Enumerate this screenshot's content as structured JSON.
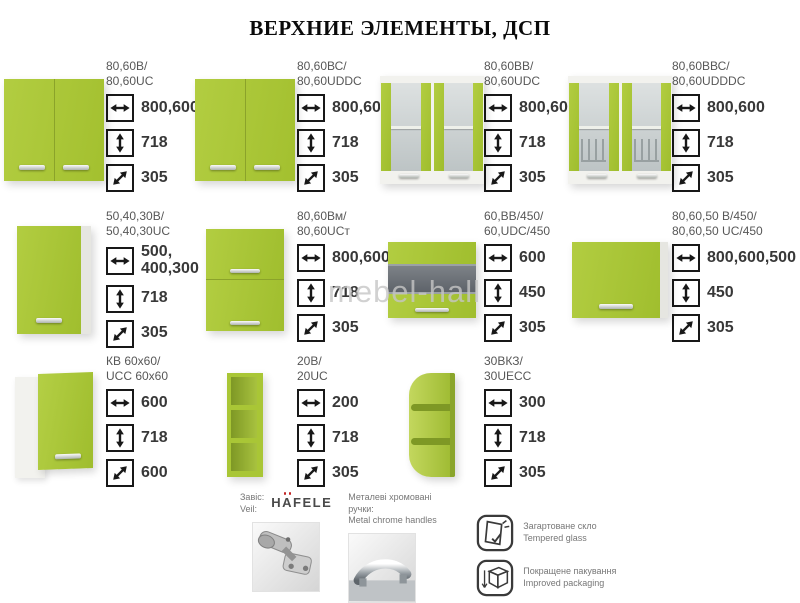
{
  "title": "ВЕРХНИЕ ЭЛЕМЕНТЫ, ДСП",
  "watermark": "mebel-hall",
  "colors": {
    "cabinet_green": "#a9c636",
    "green_dark": "#8ba32a",
    "carcass_white": "#f2f2ee",
    "glass_gray": "#c5cccd",
    "value_text": "#383838",
    "brand_accent_red": "#c22525"
  },
  "products": [
    {
      "label_line1": "80,60В/",
      "label_line2": "80,60UC",
      "type": "two-door",
      "specs": [
        {
          "icon": "width-icon",
          "value": "800,600"
        },
        {
          "icon": "height-icon",
          "value": "718"
        },
        {
          "icon": "depth-icon",
          "value": "305"
        }
      ]
    },
    {
      "label_line1": "80,60ВС/",
      "label_line2": "80,60UDDC",
      "type": "two-door",
      "specs": [
        {
          "icon": "width-icon",
          "value": "800,600"
        },
        {
          "icon": "height-icon",
          "value": "718"
        },
        {
          "icon": "depth-icon",
          "value": "305"
        }
      ]
    },
    {
      "label_line1": "80,60ВВ/",
      "label_line2": "80,60UDC",
      "type": "glass-two-door",
      "specs": [
        {
          "icon": "width-icon",
          "value": "800,600"
        },
        {
          "icon": "height-icon",
          "value": "718"
        },
        {
          "icon": "depth-icon",
          "value": "305"
        }
      ]
    },
    {
      "label_line1": "80,60ВВС/",
      "label_line2": "80,60UDDDC",
      "type": "glass-two-door-rack",
      "specs": [
        {
          "icon": "width-icon",
          "value": "800,600"
        },
        {
          "icon": "height-icon",
          "value": "718"
        },
        {
          "icon": "depth-icon",
          "value": "305"
        }
      ]
    },
    {
      "label_line1": "50,40,30В/",
      "label_line2": "50,40,30UC",
      "type": "single-door",
      "specs": [
        {
          "icon": "width-icon",
          "value": "500, 400,300"
        },
        {
          "icon": "height-icon",
          "value": "718"
        },
        {
          "icon": "depth-icon",
          "value": "305"
        }
      ]
    },
    {
      "label_line1": "80,60Вм/",
      "label_line2": "80,60UCт",
      "type": "flip-two",
      "specs": [
        {
          "icon": "width-icon",
          "value": "800,600"
        },
        {
          "icon": "height-icon",
          "value": "718"
        },
        {
          "icon": "depth-icon",
          "value": "305"
        }
      ]
    },
    {
      "label_line1": "60,ВВ/450/",
      "label_line2": "60,UDC/450",
      "type": "horizontal-glass",
      "specs": [
        {
          "icon": "width-icon",
          "value": "600"
        },
        {
          "icon": "height-icon",
          "value": "450"
        },
        {
          "icon": "depth-icon",
          "value": "305"
        }
      ]
    },
    {
      "label_line1": "80,60,50 В/450/",
      "label_line2": "80,60,50 UC/450",
      "type": "flip-one",
      "specs": [
        {
          "icon": "width-icon",
          "value": "800,600,500"
        },
        {
          "icon": "height-icon",
          "value": "450"
        },
        {
          "icon": "depth-icon",
          "value": "305"
        }
      ]
    },
    {
      "label_line1": "КВ 60х60/",
      "label_line2": "UCC 60х60",
      "type": "corner",
      "specs": [
        {
          "icon": "width-icon",
          "value": "600"
        },
        {
          "icon": "height-icon",
          "value": "718"
        },
        {
          "icon": "depth-icon",
          "value": "600"
        }
      ]
    },
    {
      "label_line1": "20В/",
      "label_line2": "20UC",
      "type": "open-shelf",
      "specs": [
        {
          "icon": "width-icon",
          "value": "200"
        },
        {
          "icon": "height-icon",
          "value": "718"
        },
        {
          "icon": "depth-icon",
          "value": "305"
        }
      ]
    },
    {
      "label_line1": "30ВКЗ/",
      "label_line2": "30UECC",
      "type": "corner-shelf",
      "specs": [
        {
          "icon": "width-icon",
          "value": "300"
        },
        {
          "icon": "height-icon",
          "value": "718"
        },
        {
          "icon": "depth-icon",
          "value": "305"
        }
      ]
    }
  ],
  "footer": {
    "hinge_label_uk": "Завіс:",
    "hinge_label_en": "Veil:",
    "hinge_brand": "HÄFELE",
    "handles_label_uk": "Металеві хромовані ручки:",
    "handles_label_en": "Metal chrome handles",
    "features": [
      {
        "icon": "tempered-glass-icon",
        "label_uk": "Загартоване скло",
        "label_en": "Tempered glass"
      },
      {
        "icon": "improved-packaging-icon",
        "label_uk": "Покращене пакування",
        "label_en": "Improved packaging"
      }
    ]
  }
}
